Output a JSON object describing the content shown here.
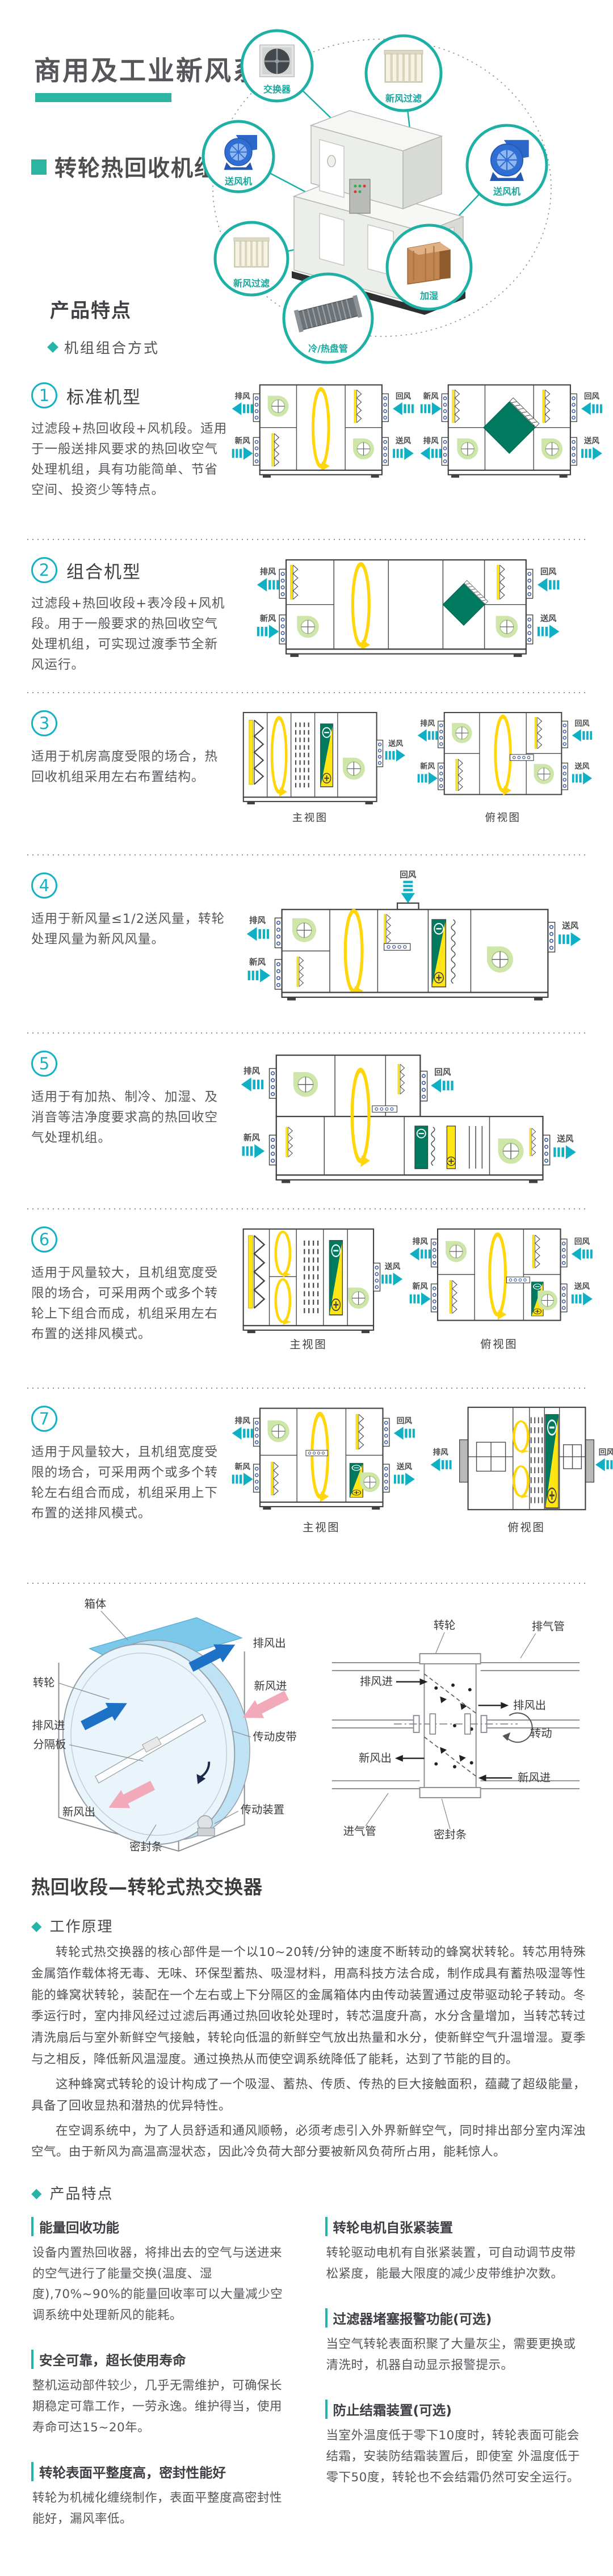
{
  "header": {
    "title": "商用及工业新风系统",
    "subtitle": "转轮热回收机组"
  },
  "hero": {
    "callouts": [
      {
        "label": "交换器"
      },
      {
        "label": "新风过滤"
      },
      {
        "label": "送风机"
      },
      {
        "label": "加湿"
      },
      {
        "label": "冷/热盘管"
      },
      {
        "label": "新风过滤"
      },
      {
        "label": "送风机"
      }
    ]
  },
  "features_header": {
    "title": "产品特点",
    "bullet": "机组组合方式"
  },
  "air": {
    "supply": "送风",
    "ret": "回风",
    "fresh": "新风",
    "exhaust": "排风"
  },
  "views": {
    "front": "主视图",
    "top": "俯视图"
  },
  "sections": [
    {
      "num": "1",
      "title": "标准机型",
      "text": "过滤段+热回收段+风机段。适用于一般送排风要求的热回收空气处理机组，具有功能简单、节省空间、投资少等特点。"
    },
    {
      "num": "2",
      "title": "组合机型",
      "text": "过滤段+热回收段+表冷段+风机段。用于一般要求的热回收空气处理机组，可实现过渡季节全新风运行。"
    },
    {
      "num": "3",
      "title": "",
      "text": "适用于机房高度受限的场合，热回收机组采用左右布置结构。"
    },
    {
      "num": "4",
      "title": "",
      "text": "适用于新风量≤1/2送风量，转轮处理风量为新风风量。"
    },
    {
      "num": "5",
      "title": "",
      "text": "适用于有加热、制冷、加湿、及消音等洁净度要求高的热回收空气处理机组。"
    },
    {
      "num": "6",
      "title": "",
      "text": "适用于风量较大，且机组宽度受限的场合，可采用两个或多个转轮上下组合而成，机组采用左右布置的送排风模式。"
    },
    {
      "num": "7",
      "title": "",
      "text": "适用于风量较大，且机组宽度受限的场合，可采用两个或多个转轮左右组合而成，机组采用上下布置的送排风模式。"
    }
  ],
  "wheel_iso": {
    "cabinet": "箱体",
    "exhaust_out": "排风出",
    "wheel": "转轮",
    "exhaust_in": "排风进",
    "divider": "分隔板",
    "fresh_in": "新风进",
    "belt": "传动皮带",
    "fresh_out": "新风出",
    "drive": "传动装置",
    "seal": "密封条"
  },
  "cross_section": {
    "wheel": "转轮",
    "exhaust_pipe": "排气管",
    "exhaust_in": "排风进",
    "exhaust_out": "排风出",
    "rotate": "转动",
    "fresh_out": "新风出",
    "fresh_in": "新风进",
    "seal": "密封条",
    "intake_pipe": "进气管"
  },
  "recovery": {
    "heading": "热回收段—转轮式热交换器",
    "principle_title": "工作原理",
    "paragraphs": [
      "转轮式热交换器的核心部件是一个以10~20转/分钟的速度不断转动的蜂窝状转轮。转芯用特殊金属箔作载体将无毒、无味、环保型蓄热、吸湿材料，用高科技方法合成，制作成具有蓄热吸湿等性能的蜂窝状转轮，装配在一个左右或上下分隔区的金属箱体内由传动装置通过皮带驱动轮子转动。冬季运行时，室内排风经过过滤后再通过热回收轮处理时，转芯温度升高，水分含量增加，当转芯转过清洗扇后与室外新鲜空气接触，转轮向低温的新鲜空气放出热量和水分，使新鲜空气升温增湿。夏季与之相反，降低新风温湿度。通过换热从而使空调系统降低了能耗，达到了节能的目的。",
      "这种蜂窝式转轮的设计构成了一个吸湿、蓄热、传质、传热的巨大接触面积，蕴藏了超级能量，具备了回收显热和潜热的优异特性。",
      "在空调系统中，为了人员舒适和通风顺畅，必须考虑引入外界新鲜空气，同时排出部分室内浑浊空气。由于新风为高温高湿状态，因此冷负荷大部分要被新风负荷所占用，能耗惊人。"
    ]
  },
  "bottom_features": {
    "title": "产品特点",
    "items": [
      {
        "title": "能量回收功能",
        "text": "设备内置热回收器，将排出去的空气与送进来的空气进行了能量交换(温度、湿度),70%~90%的能量回收率可以大量减少空调系统中处理新风的能耗。"
      },
      {
        "title": "安全可靠，超长使用寿命",
        "text": "整机运动部件较少，几乎无需维护，可确保长期稳定可靠工作，一劳永逸。维护得当，使用寿命可达15~20年。"
      },
      {
        "title": "转轮表面平整度高，密封性能好",
        "text": "转轮为机械化缠绕制作，表面平整度高密封性能好，漏风率低。"
      },
      {
        "title": "转轮电机自张紧装置",
        "text": "转轮驱动电机有自张紧装置，可自动调节皮带松紧度，能最大限度的减少皮带维护次数。"
      },
      {
        "title": "过滤器堵塞报警功能(可选)",
        "text": "当空气转轮表面积聚了大量灰尘，需要更换或清洗时，机器自动显示报警提示。"
      },
      {
        "title": "防止结霜装置(可选)",
        "text": "当室外温度低于零下10度时，转轮表面可能会结霜，安装防结霜装置后，即使室 外温度低于零下50度，转轮也不会结霜仍然可安全运行。"
      }
    ]
  }
}
